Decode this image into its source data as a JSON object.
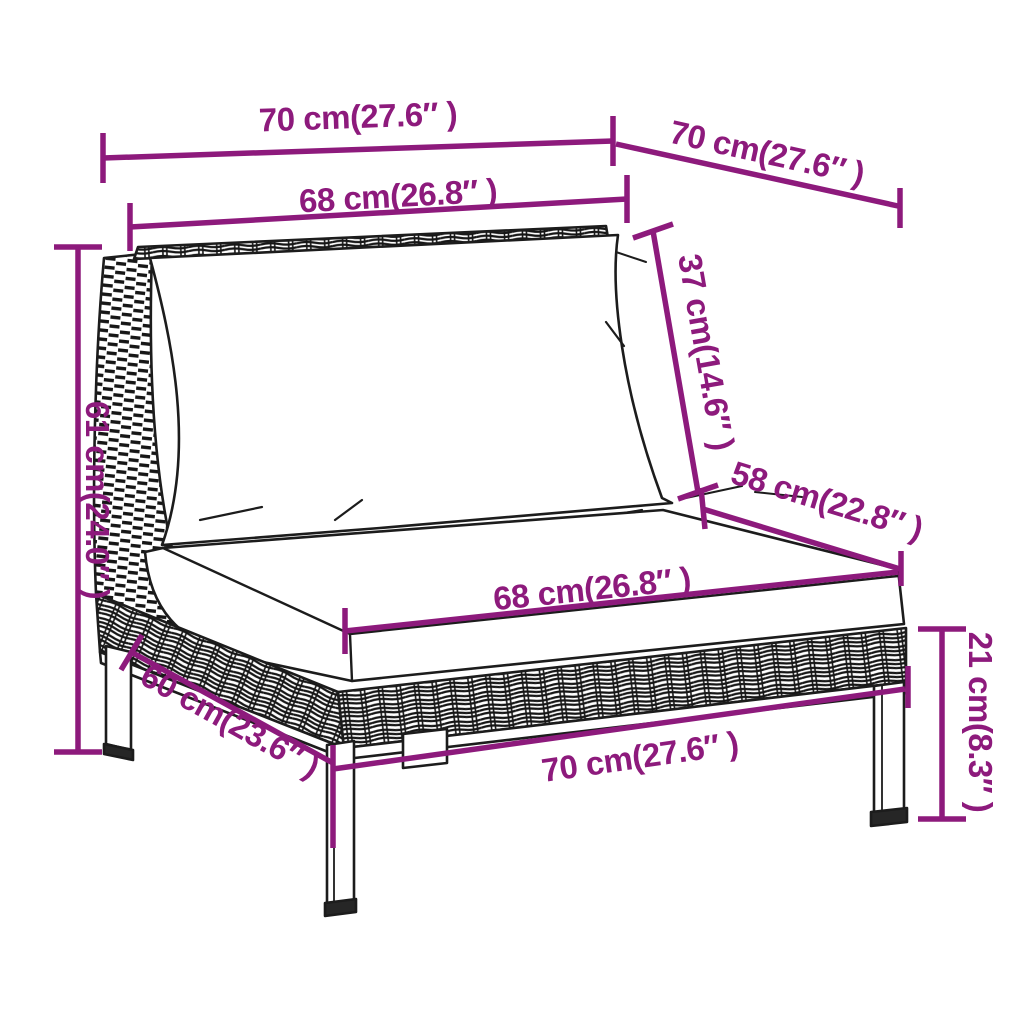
{
  "meta": {
    "diagram_type": "furniture dimension diagram",
    "subject": "rattan sofa middle section with cushions",
    "accent_color": "#8d1a7c",
    "outline_color": "#1c1c1c",
    "background_color": "#ffffff"
  },
  "measurements": {
    "top_width": {
      "label": "70 cm(27.6″ )",
      "cm": 70,
      "inches": 27.6
    },
    "top_depth": {
      "label": "70 cm(27.6″ )",
      "cm": 70,
      "inches": 27.6
    },
    "back_width": {
      "label": "68 cm(26.8″ )",
      "cm": 68,
      "inches": 26.8
    },
    "back_height": {
      "label": "37 cm(14.6″ )",
      "cm": 37,
      "inches": 14.6
    },
    "seat_depth": {
      "label": "58 cm(22.8″ )",
      "cm": 58,
      "inches": 22.8
    },
    "total_height": {
      "label": "61 cm(24.0″ )",
      "cm": 61,
      "inches": 24.0
    },
    "seat_width": {
      "label": "68 cm(26.8″ )",
      "cm": 68,
      "inches": 26.8
    },
    "seat_height": {
      "label": "21 cm(8.3″ )",
      "cm": 21,
      "inches": 8.3
    },
    "side_depth": {
      "label": "60 cm(23.6″ )",
      "cm": 60,
      "inches": 23.6
    },
    "bottom_width": {
      "label": "70 cm(27.6″ )",
      "cm": 70,
      "inches": 27.6
    }
  }
}
